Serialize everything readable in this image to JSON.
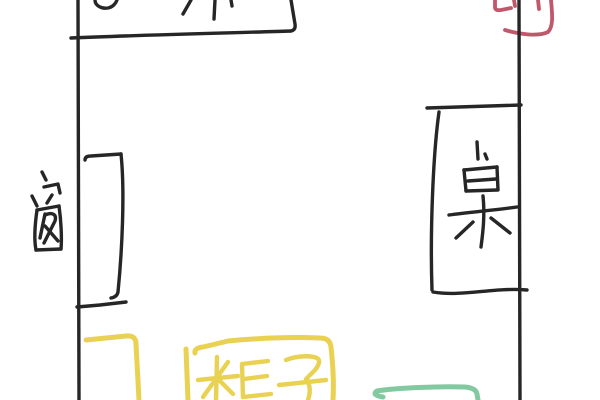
{
  "canvas": {
    "width": 600,
    "height": 400,
    "background": "#ffffff"
  },
  "sketch": {
    "type": "hand-drawn room floor plan",
    "labels": {
      "window": "窗",
      "table": "桌",
      "cabinet": "柜子"
    },
    "cropped_marks": {
      "top_box_label": "partial black strokes cropped by top edge",
      "door_red_mark": "partial red strokes cropped by top edge",
      "green_outline": "green outline cropped by bottom edge"
    },
    "colors": {
      "ink": "#262626",
      "red_mark": "#c2566b",
      "cabinet_yellow": "#e9d152",
      "green_item": "#82c9a0"
    }
  }
}
